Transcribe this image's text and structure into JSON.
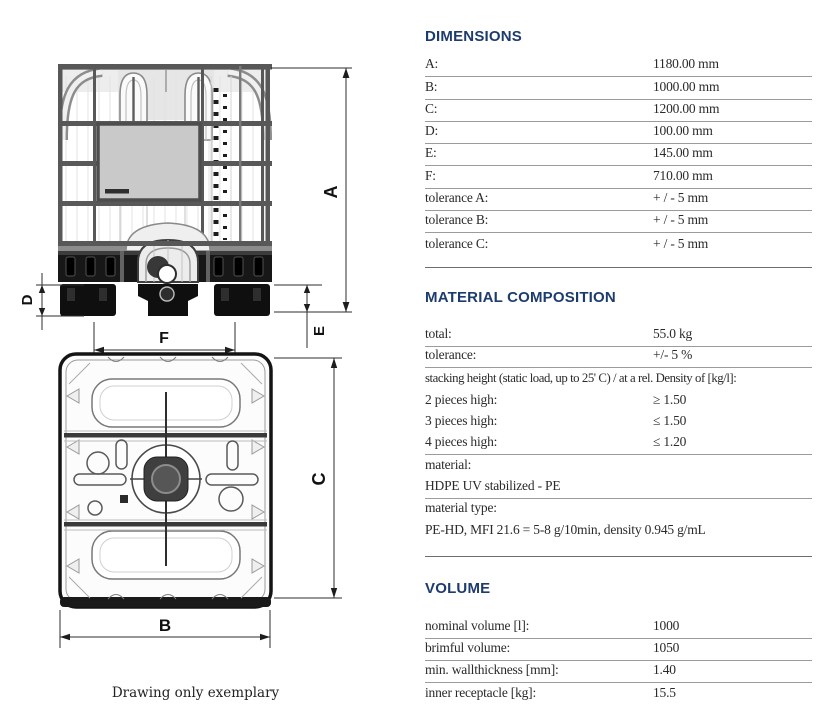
{
  "colors": {
    "heading": "#1d3c6e",
    "row_rule": "#9b9b9b",
    "section_rule": "#6e6e6e",
    "text": "#2a2a2a"
  },
  "drawing": {
    "caption": "Drawing only exemplary",
    "labels": {
      "a": "A",
      "b": "B",
      "c": "C",
      "d": "D",
      "e": "E",
      "f": "F"
    }
  },
  "sections": [
    {
      "title": "DIMENSIONS",
      "rows": [
        {
          "label": "A:",
          "value": "1180.00 mm"
        },
        {
          "label": "B:",
          "value": "1000.00 mm"
        },
        {
          "label": "C:",
          "value": "1200.00 mm"
        },
        {
          "label": "D:",
          "value": "100.00 mm"
        },
        {
          "label": "E:",
          "value": "145.00 mm"
        },
        {
          "label": "F:",
          "value": "710.00 mm"
        },
        {
          "label": "tolerance A:",
          "value": "+ / - 5 mm"
        },
        {
          "label": "tolerance B:",
          "value": "+ / - 5 mm"
        },
        {
          "label": "tolerance C:",
          "value": "+ / - 5 mm"
        }
      ]
    },
    {
      "title": "MATERIAL COMPOSITION",
      "rows": [
        {
          "label": "total:",
          "value": "55.0 kg"
        },
        {
          "label": "tolerance:",
          "value": "+/- 5 %"
        },
        {
          "label": "stacking height (static load, up to 25' C) / at a rel. Density of [kg/l]:"
        },
        {
          "label": "2 pieces high:",
          "value": "≥ 1.50"
        },
        {
          "label": "3 pieces high:",
          "value": "≤ 1.50"
        },
        {
          "label": "4 pieces high:",
          "value": "≤ 1.20"
        },
        {
          "label": "material:"
        },
        {
          "label": "HDPE UV stabilized - PE"
        },
        {
          "label": "material type:"
        },
        {
          "label": "PE-HD, MFI 21.6 = 5-8 g/10min, density 0.945 g/mL"
        }
      ]
    },
    {
      "title": "VOLUME",
      "rows": [
        {
          "label": "nominal volume [l]:",
          "value": "1000"
        },
        {
          "label": "brimful volume:",
          "value": "1050"
        },
        {
          "label": "min. wallthickness [mm]:",
          "value": "1.40"
        },
        {
          "label": "inner receptacle [kg]:",
          "value": "15.5"
        }
      ]
    }
  ]
}
